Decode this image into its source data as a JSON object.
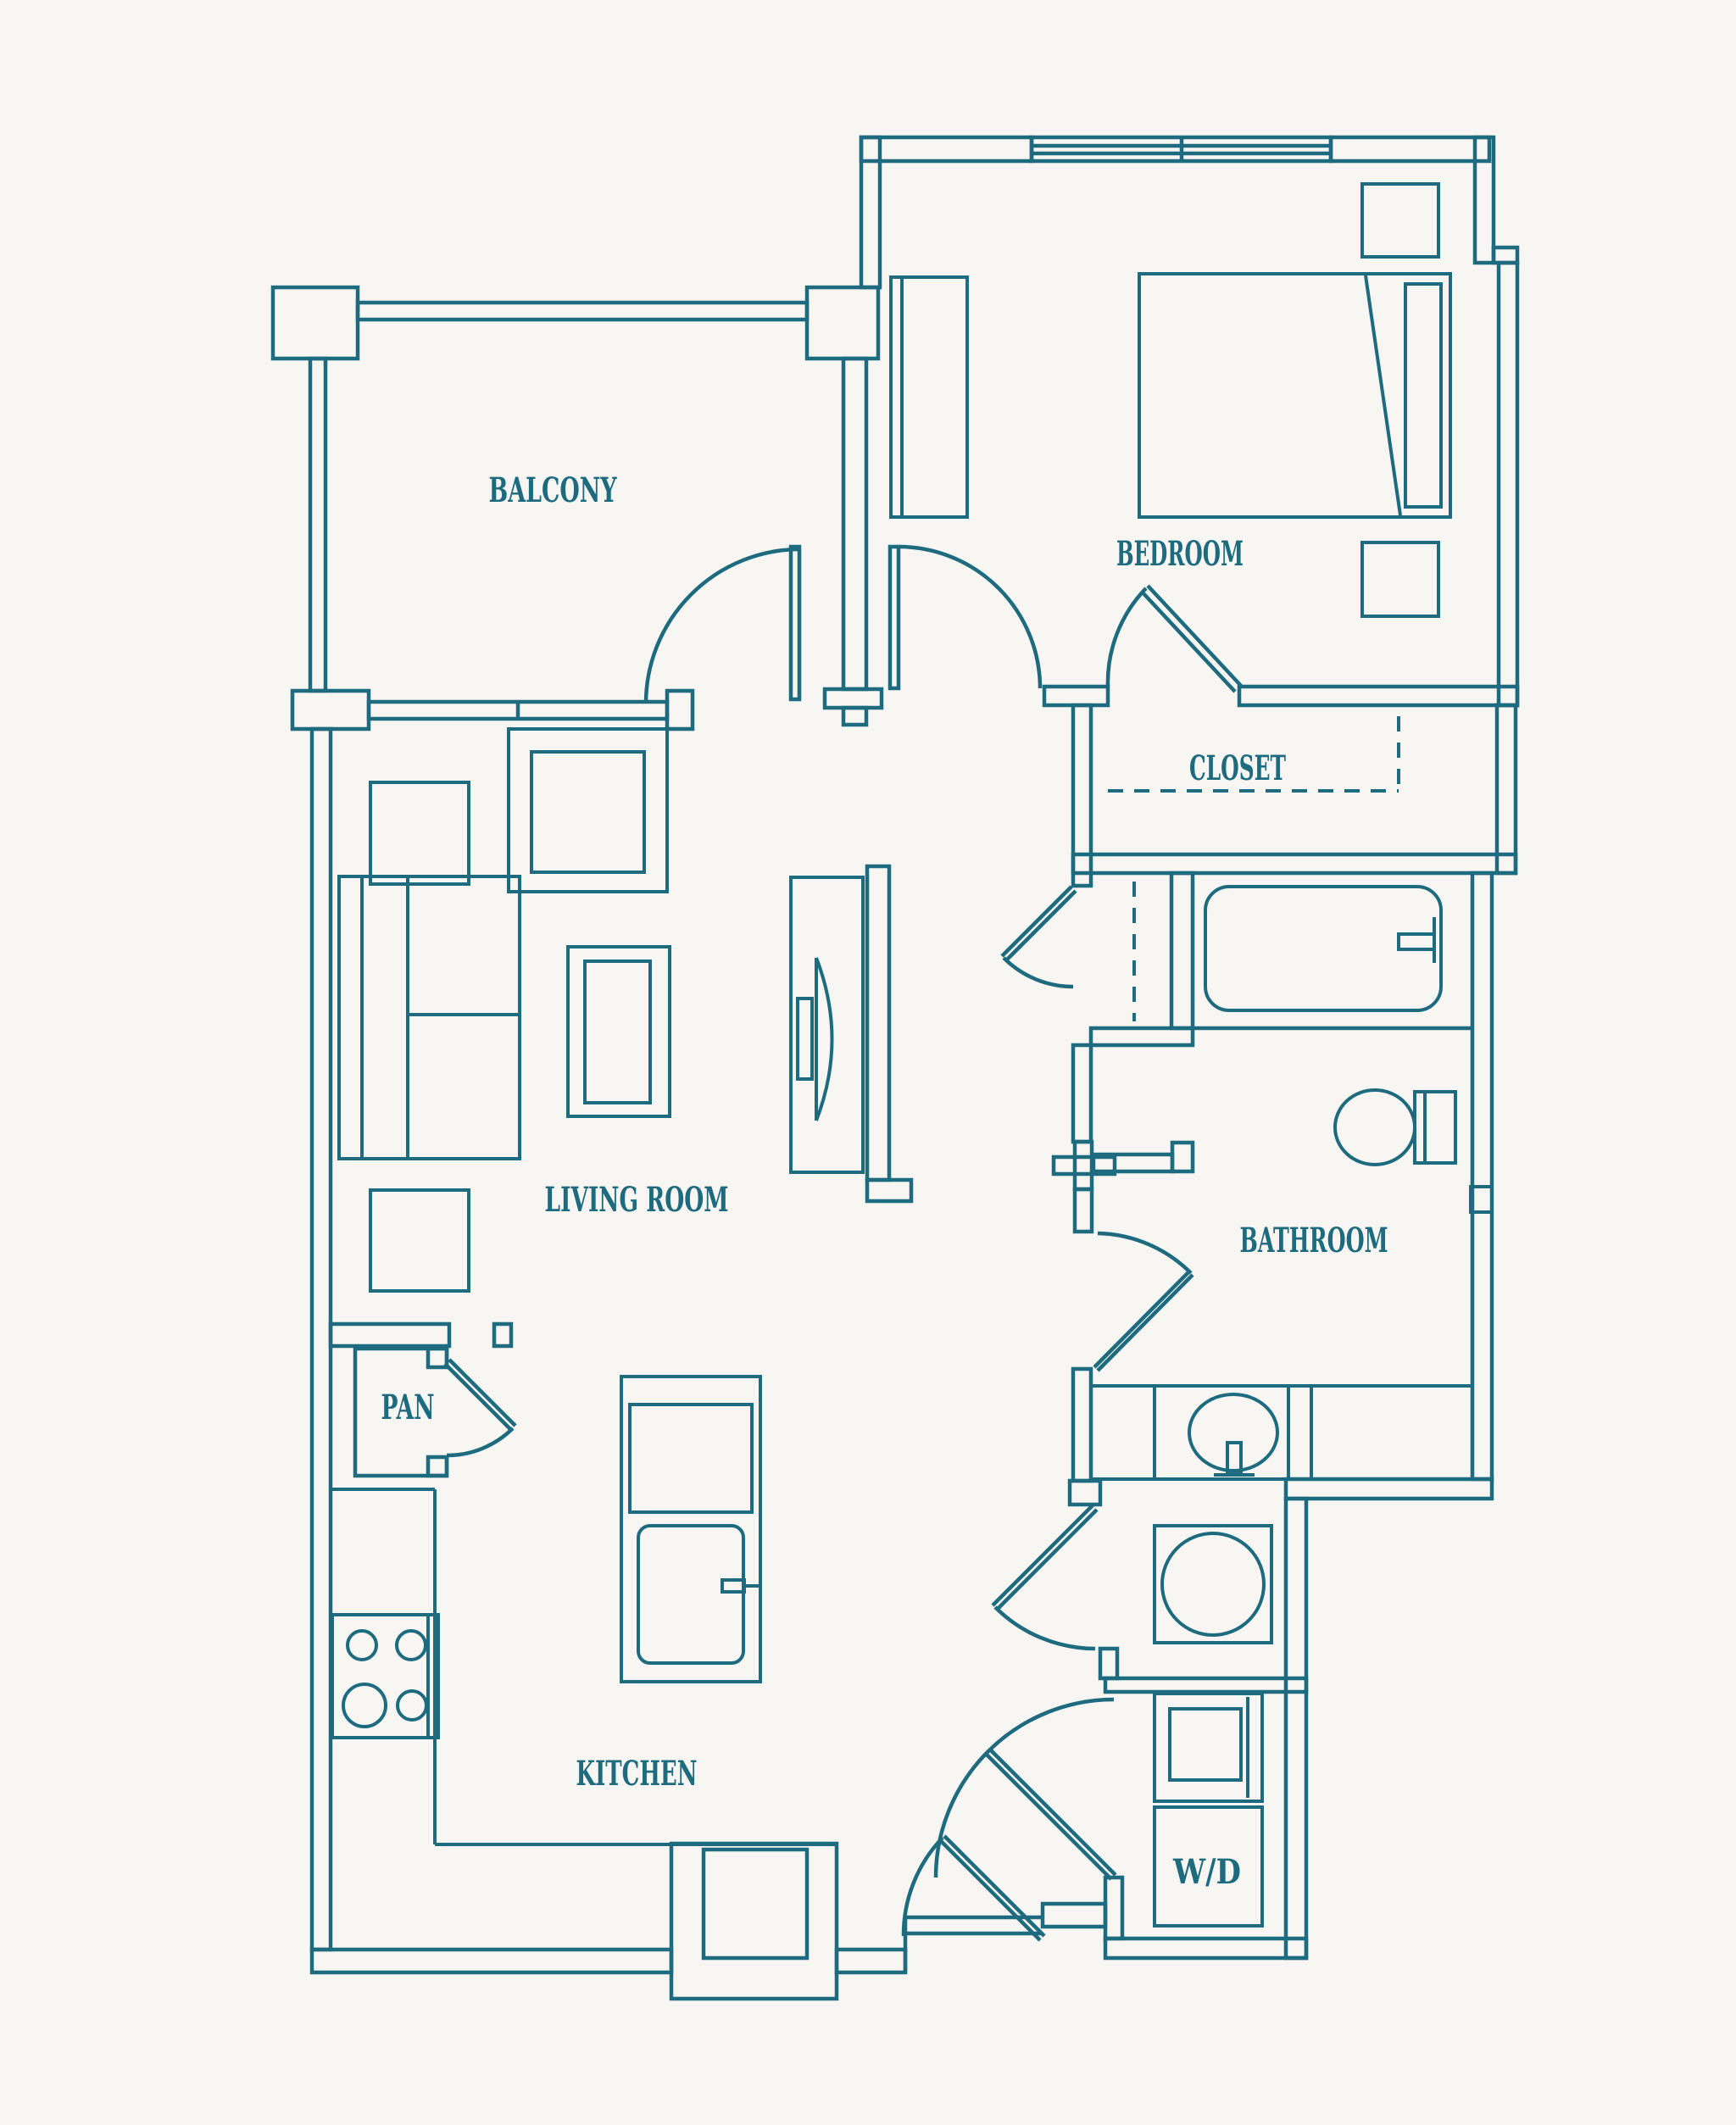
{
  "plan": {
    "type": "apartment-floor-plan"
  },
  "colors": {
    "line": "#1e6b80",
    "background": "#f7f6f2",
    "label_text": "#1e6b80"
  },
  "rooms": {
    "balcony": "BALCONY",
    "bedroom": "BEDROOM",
    "closet": "CLOSET",
    "living_room": "LIVING ROOM",
    "bathroom": "BATHROOM",
    "pantry": "PAN",
    "kitchen": "KITCHEN",
    "washer_dryer": "W/D"
  }
}
